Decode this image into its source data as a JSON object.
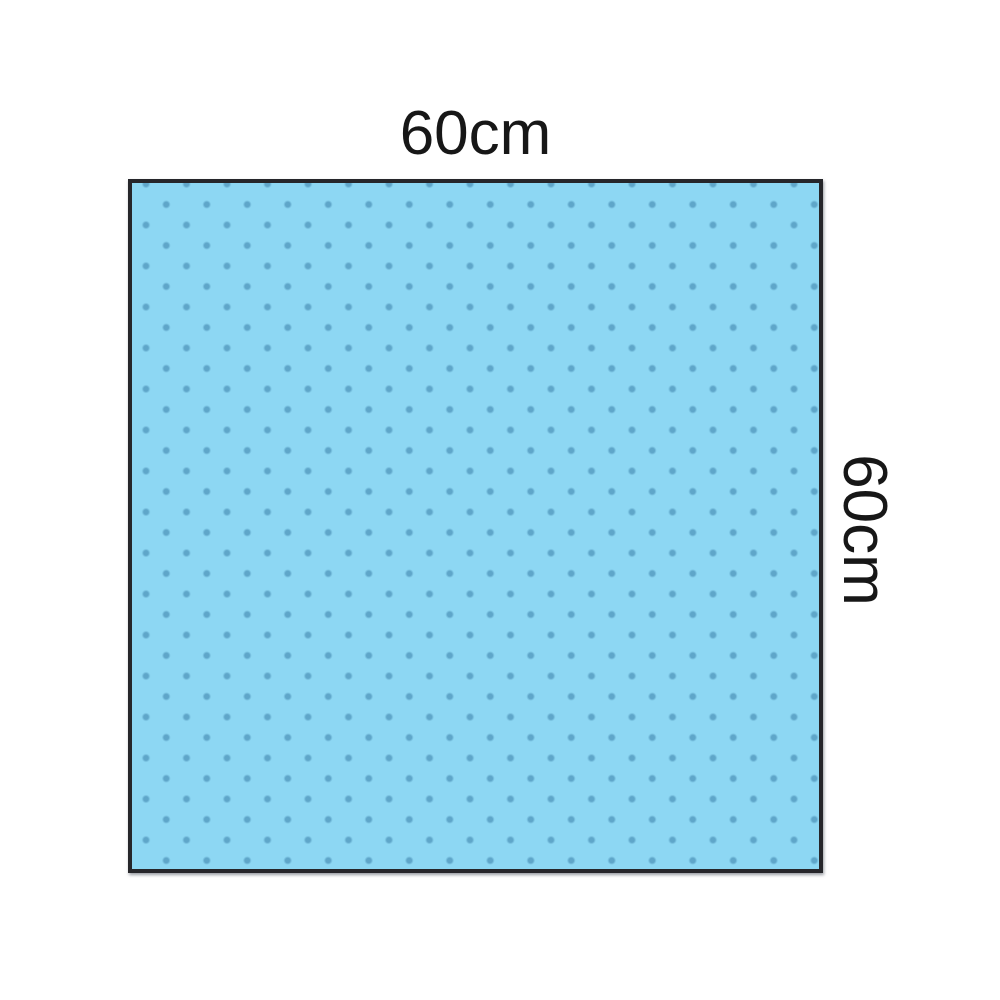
{
  "diagram": {
    "description": "Dimensional illustration of a square polka-dot drape sheet",
    "top_label": "60cm",
    "right_label": "60cm",
    "drape": {
      "shape": "square",
      "width_label": "60cm",
      "height_label": "60cm",
      "fill_color": "#8dd7f3",
      "dot_color": "#5fa6c9",
      "border_color": "#26262a",
      "label_color": "#171717"
    },
    "page_background": "#ffffff"
  }
}
